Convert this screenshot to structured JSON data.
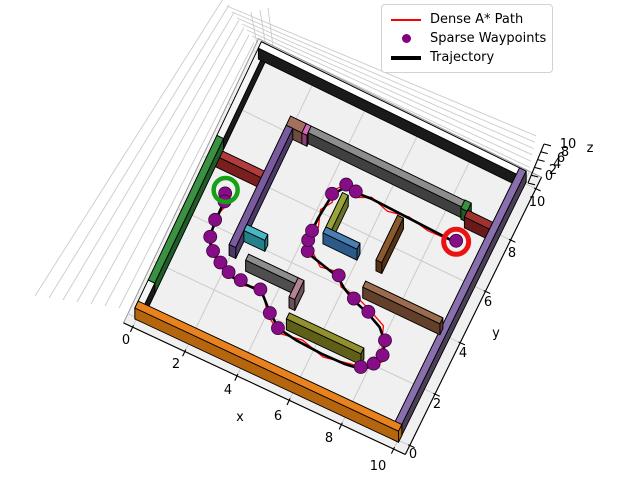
{
  "figure": {
    "background": "#ffffff"
  },
  "legend": {
    "items": [
      {
        "label": "Dense A* Path",
        "swatch": "red-line-icon",
        "color": "#ff0000"
      },
      {
        "label": "Sparse Waypoints",
        "swatch": "purple-dot-icon",
        "color": "#800080"
      },
      {
        "label": "Trajectory",
        "swatch": "black-line-icon",
        "color": "#000000"
      }
    ]
  },
  "axes": {
    "x": {
      "label": "x",
      "ticks": [
        "0",
        "2",
        "4",
        "6",
        "8",
        "10"
      ]
    },
    "y": {
      "label": "y",
      "ticks": [
        "0",
        "2",
        "4",
        "6",
        "8",
        "10"
      ]
    },
    "z": {
      "label": "z",
      "ticks": [
        "0",
        "2",
        "4",
        "6",
        "8",
        "10"
      ]
    }
  },
  "chart_data": {
    "type": "line",
    "projection": "3d",
    "title": "",
    "xlabel": "x",
    "ylabel": "y",
    "zlabel": "z",
    "xlim": [
      0,
      10
    ],
    "ylim": [
      0,
      10
    ],
    "zlim": [
      0,
      10
    ],
    "grid": true,
    "legend_position": "upper right",
    "start": {
      "x": 1.0,
      "y": 5.0,
      "marker": "green-ring",
      "color": "#17a017"
    },
    "goal": {
      "x": 8.9,
      "y": 6.9,
      "marker": "red-ring",
      "color": "#ea1212"
    },
    "floor_color": "#f0f0f0",
    "walls": [
      {
        "name": "boundary-top",
        "x1": -0.05,
        "y1": 9.82,
        "x2": 10.05,
        "y2": 10.06,
        "top": "#ffffff",
        "side": "#1a1a1a"
      },
      {
        "name": "boundary-left-upper",
        "x1": -0.05,
        "y1": 6.5,
        "x2": 0.2,
        "y2": 10.06,
        "top": "#f5f5f5",
        "side": "#1a1a1a"
      },
      {
        "name": "boundary-left-green",
        "x1": -0.05,
        "y1": 1.0,
        "x2": 0.2,
        "y2": 6.5,
        "top": "#3a9142",
        "side": "#1f5c27"
      },
      {
        "name": "boundary-left-lower",
        "x1": -0.05,
        "y1": -0.06,
        "x2": 0.2,
        "y2": 1.0,
        "top": "#f5f5f5",
        "side": "#1a1a1a"
      },
      {
        "name": "boundary-bottom-orange",
        "x1": -0.05,
        "y1": -0.06,
        "x2": 10.05,
        "y2": 0.2,
        "top": "#e8821e",
        "side": "#b5650e"
      },
      {
        "name": "boundary-right-purple",
        "x1": 9.8,
        "y1": -0.06,
        "x2": 10.05,
        "y2": 10.06,
        "top": "#8a6fae",
        "side": "#4a3f57"
      },
      {
        "name": "wall-red",
        "x1": 0.2,
        "y1": 5.85,
        "x2": 1.95,
        "y2": 6.1,
        "top": "#b23b3b",
        "side": "#7a1f1f"
      },
      {
        "name": "wall-purple-long",
        "x1": 1.95,
        "y1": 3.3,
        "x2": 2.2,
        "y2": 7.85,
        "top": "#7a5c9e",
        "side": "#4c3968"
      },
      {
        "name": "block-brown",
        "x1": 1.95,
        "y1": 7.85,
        "x2": 2.55,
        "y2": 8.2,
        "top": "#a3705f",
        "side": "#704c3c"
      },
      {
        "name": "post-pink",
        "x1": 2.55,
        "y1": 7.85,
        "x2": 2.74,
        "y2": 8.2,
        "top": "#d46bb8",
        "side": "#8f3d78"
      },
      {
        "name": "wall-gray-long",
        "x1": 2.74,
        "y1": 7.95,
        "x2": 8.6,
        "y2": 8.2,
        "top": "#8d8d8d",
        "side": "#404040"
      },
      {
        "name": "wall-green-short",
        "x1": 8.6,
        "y1": 7.9,
        "x2": 8.84,
        "y2": 8.22,
        "top": "#3a9142",
        "side": "#1f5c27"
      },
      {
        "name": "wall-maroon",
        "x1": 8.84,
        "y1": 7.68,
        "x2": 9.8,
        "y2": 7.94,
        "top": "#a03232",
        "side": "#691b1b"
      },
      {
        "name": "wall-teal",
        "x1": 2.2,
        "y1": 3.95,
        "x2": 3.0,
        "y2": 4.18,
        "top": "#49b8c4",
        "side": "#26808c"
      },
      {
        "name": "wall-gray-mid",
        "x1": 2.7,
        "y1": 3.05,
        "x2": 4.6,
        "y2": 3.28,
        "top": "#8d8d8d",
        "side": "#4e4e4e"
      },
      {
        "name": "post-rose",
        "x1": 4.6,
        "y1": 2.55,
        "x2": 4.82,
        "y2": 3.28,
        "top": "#b5838f",
        "side": "#6b525c"
      },
      {
        "name": "wall-olive-long",
        "x1": 4.85,
        "y1": 1.82,
        "x2": 7.7,
        "y2": 2.05,
        "top": "#90902e",
        "side": "#5f5f1a"
      },
      {
        "name": "wall-blue",
        "x1": 4.7,
        "y1": 5.05,
        "x2": 6.0,
        "y2": 5.28,
        "top": "#4a7fb5",
        "side": "#2b5a88"
      },
      {
        "name": "wall-olive-vert",
        "x1": 4.7,
        "y1": 5.28,
        "x2": 4.92,
        "y2": 6.6,
        "top": "#9aa33c",
        "side": "#697224"
      },
      {
        "name": "wall-brown-vert",
        "x1": 6.75,
        "y1": 5.0,
        "x2": 6.97,
        "y2": 6.72,
        "top": "#8a5a2e",
        "side": "#533216"
      },
      {
        "name": "wall-brown-long",
        "x1": 6.75,
        "y1": 3.95,
        "x2": 9.7,
        "y2": 4.18,
        "top": "#9a6b4f",
        "side": "#63402c"
      }
    ],
    "series": [
      {
        "name": "Dense A* Path",
        "color": "#ff0000",
        "width": 1.3,
        "points": [
          [
            1.0,
            5.0
          ],
          [
            1.18,
            4.55
          ],
          [
            1.02,
            4.05
          ],
          [
            1.25,
            3.35
          ],
          [
            1.5,
            2.92
          ],
          [
            1.95,
            2.6
          ],
          [
            2.3,
            2.62
          ],
          [
            2.85,
            2.35
          ],
          [
            3.55,
            2.6
          ],
          [
            4.15,
            1.8
          ],
          [
            4.8,
            1.42
          ],
          [
            5.6,
            1.55
          ],
          [
            6.5,
            1.32
          ],
          [
            7.4,
            1.5
          ],
          [
            8.05,
            1.62
          ],
          [
            8.45,
            2.1
          ],
          [
            8.12,
            2.6
          ],
          [
            7.9,
            3.2
          ],
          [
            7.22,
            3.5
          ],
          [
            6.6,
            3.72
          ],
          [
            6.0,
            3.78
          ],
          [
            5.7,
            4.22
          ],
          [
            5.05,
            4.1
          ],
          [
            4.5,
            4.52
          ],
          [
            4.15,
            4.82
          ],
          [
            4.4,
            5.3
          ],
          [
            4.2,
            5.9
          ],
          [
            4.45,
            6.3
          ],
          [
            4.28,
            6.68
          ],
          [
            4.72,
            7.15
          ],
          [
            5.1,
            6.8
          ],
          [
            5.6,
            7.05
          ],
          [
            6.3,
            6.85
          ],
          [
            7.05,
            7.0
          ],
          [
            7.85,
            6.85
          ],
          [
            8.9,
            6.9
          ]
        ]
      },
      {
        "name": "Trajectory",
        "color": "#000000",
        "width": 2.6,
        "points": [
          [
            1.0,
            5.0
          ],
          [
            1.08,
            4.6
          ],
          [
            1.1,
            4.0
          ],
          [
            1.15,
            3.35
          ],
          [
            1.45,
            3.0
          ],
          [
            1.9,
            2.7
          ],
          [
            2.3,
            2.5
          ],
          [
            2.8,
            2.45
          ],
          [
            3.6,
            2.45
          ],
          [
            4.2,
            1.9
          ],
          [
            4.7,
            1.55
          ],
          [
            5.4,
            1.45
          ],
          [
            6.4,
            1.4
          ],
          [
            7.3,
            1.42
          ],
          [
            7.85,
            1.5
          ],
          [
            8.2,
            1.8
          ],
          [
            8.35,
            2.2
          ],
          [
            8.2,
            2.7
          ],
          [
            7.8,
            3.1
          ],
          [
            7.25,
            3.35
          ],
          [
            6.6,
            3.55
          ],
          [
            6.1,
            3.8
          ],
          [
            5.75,
            4.05
          ],
          [
            5.1,
            4.2
          ],
          [
            4.45,
            4.35
          ],
          [
            4.3,
            4.7
          ],
          [
            4.25,
            5.1
          ],
          [
            4.25,
            5.6
          ],
          [
            4.3,
            6.1
          ],
          [
            4.35,
            6.55
          ],
          [
            4.65,
            7.0
          ],
          [
            5.05,
            6.95
          ],
          [
            5.6,
            7.0
          ],
          [
            8.9,
            6.9
          ]
        ]
      },
      {
        "name": "Sparse Waypoints",
        "color": "#870d87",
        "marker_radius": 6.5,
        "points": [
          [
            1.02,
            4.92
          ],
          [
            1.12,
            4.66
          ],
          [
            1.1,
            3.95
          ],
          [
            1.2,
            3.35
          ],
          [
            1.5,
            2.95
          ],
          [
            1.9,
            2.7
          ],
          [
            2.3,
            2.52
          ],
          [
            2.8,
            2.45
          ],
          [
            3.55,
            2.45
          ],
          [
            4.2,
            1.85
          ],
          [
            4.68,
            1.5
          ],
          [
            7.85,
            1.5
          ],
          [
            8.2,
            1.8
          ],
          [
            8.35,
            2.2
          ],
          [
            8.2,
            2.7
          ],
          [
            7.25,
            3.35
          ],
          [
            6.6,
            3.55
          ],
          [
            5.78,
            4.05
          ],
          [
            4.45,
            4.35
          ],
          [
            4.3,
            4.7
          ],
          [
            4.28,
            5.05
          ],
          [
            4.35,
            6.5
          ],
          [
            4.65,
            7.0
          ],
          [
            5.05,
            6.93
          ],
          [
            8.9,
            6.9
          ]
        ]
      }
    ]
  }
}
